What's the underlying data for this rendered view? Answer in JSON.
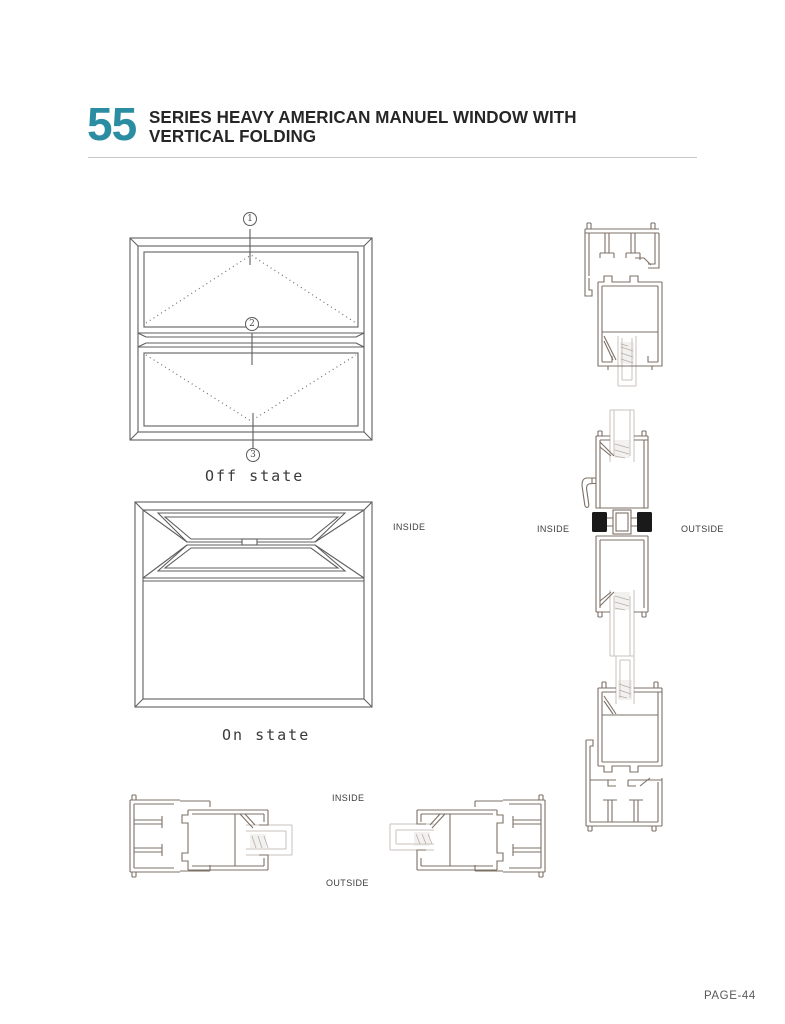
{
  "header": {
    "series_number": "55",
    "title_line1": "SERIES  HEAVY AMERICAN MANUEL WINDOW WITH",
    "title_line2": "VERTICAL FOLDING"
  },
  "elevations": {
    "off_state": {
      "label": "Off state",
      "markers": [
        "1",
        "2",
        "3"
      ]
    },
    "on_state": {
      "label": "On state"
    },
    "view_side_label": "INSIDE"
  },
  "sections": {
    "meeting_rail": {
      "inside_label": "INSIDE",
      "outside_label": "OUTSIDE"
    },
    "jamb": {
      "inside_label": "INSIDE",
      "outside_label": "OUTSIDE"
    }
  },
  "footer": {
    "page_label": "PAGE-44"
  },
  "colors": {
    "accent": "#2b8da2",
    "elevation_line": "#5f5f5f",
    "profile_line": "#7d7067",
    "glass_line": "#c8c2bd"
  }
}
